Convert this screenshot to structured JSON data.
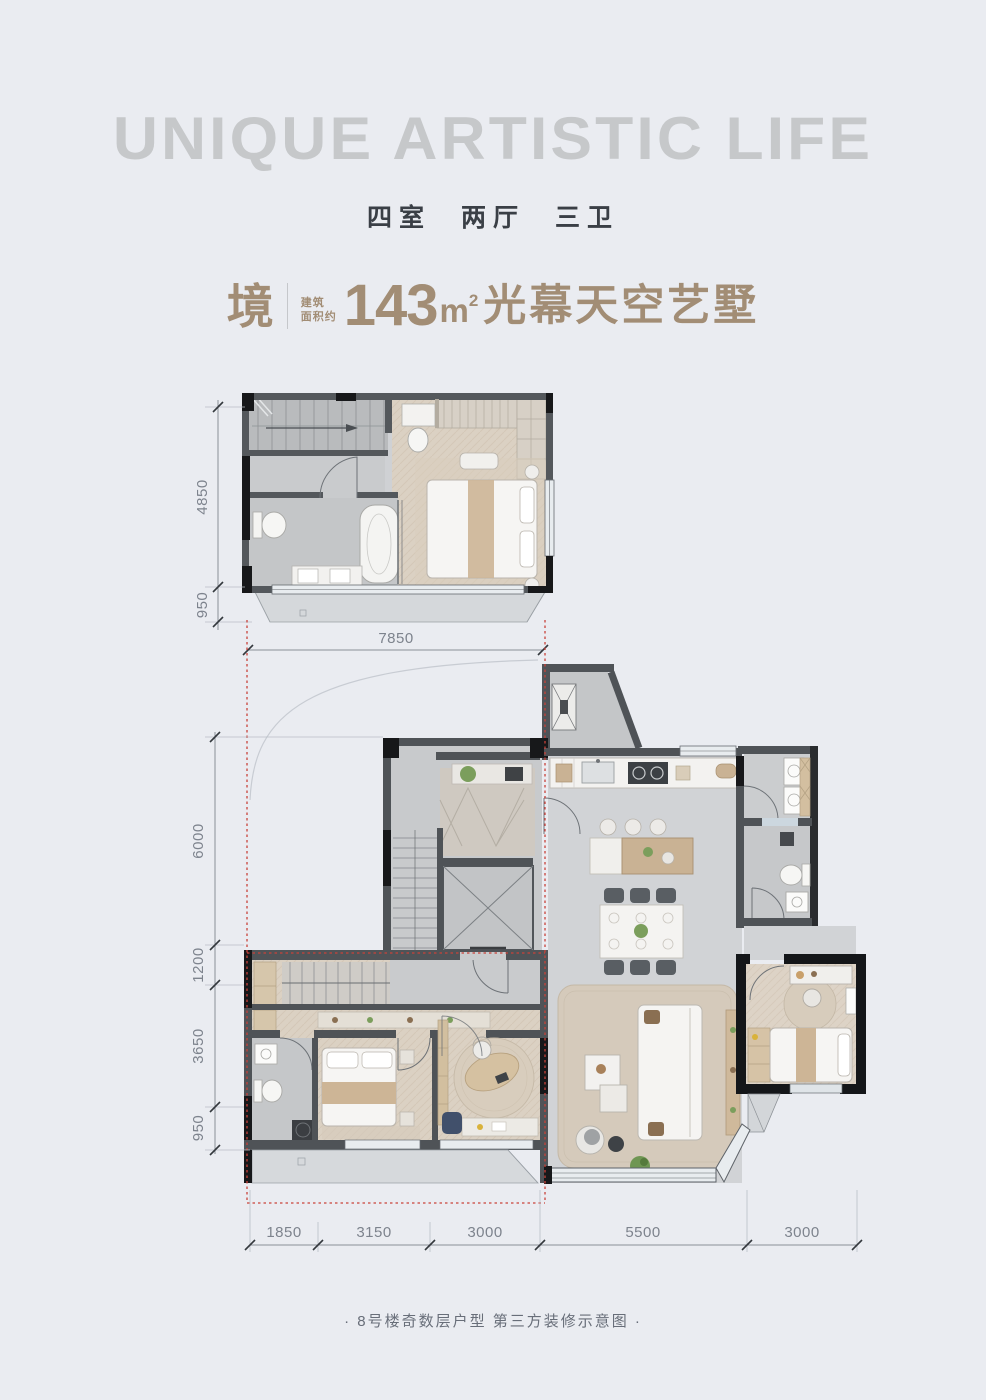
{
  "header": {
    "title_en": "UNIQUE ARTISTIC LIFE",
    "rooms_cn": "四室 两厅 三卫"
  },
  "unit": {
    "prefix": "境",
    "area_label_l1": "建筑",
    "area_label_l2": "面积约",
    "area_number": "143",
    "area_unit_base": "m",
    "area_unit_sup": "2",
    "name": "光幕天空艺墅"
  },
  "plans": {
    "upper": {
      "dims_left": [
        "4850",
        "950"
      ],
      "dims_bottom": [
        "7850"
      ]
    },
    "lower": {
      "dims_left": [
        "6000",
        "1200",
        "3650",
        "950"
      ],
      "dims_bottom": [
        "1850",
        "3150",
        "3000",
        "5500",
        "3000"
      ]
    },
    "stair_up_mark": "上"
  },
  "footer": {
    "note": "· 8号楼奇数层户型 第三方装修示意图 ·"
  },
  "colors": {
    "page_bg": "#eaecf1",
    "headline_gray": "#c6c8ca",
    "rooms_dark": "#3a3f46",
    "title_brown": "#a28d75",
    "dim_gray": "#7d838d",
    "accent_red": "#c9423a",
    "wall_dark": "#4f5357",
    "wall_black": "#17181a",
    "wood_floor": "#dbd1c3",
    "marble_floor": "#d1d3d6",
    "window_blue": "#e8ecef"
  }
}
